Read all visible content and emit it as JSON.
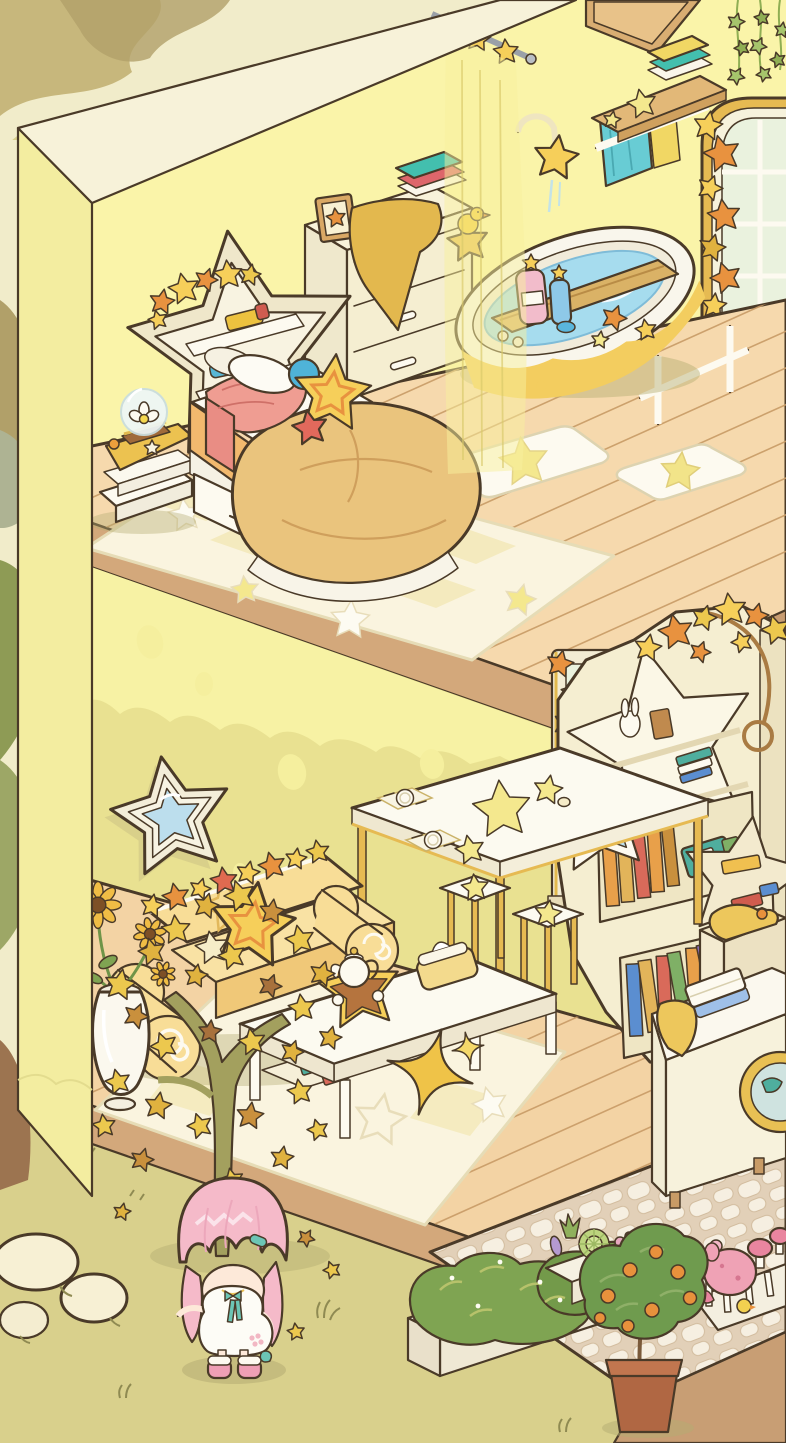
{
  "scene": {
    "description": "two-story isometric dollhouse room: bedroom and bath upstairs, living area downstairs, garden outside with avatar",
    "labels": {
      "canvas": "isometric room scene",
      "backdrop": "outside backdrop foliage",
      "ground": "outdoor ground",
      "leftWall": "outer left wall",
      "upperWall": "upper bedroom wall",
      "lowerWall": "lower living-room wall",
      "upperFloor": "upper wooden plank floor",
      "lowerFloor": "lower wooden plank floor",
      "patio": "cobblestone patio",
      "archWindow": "arched window with star garland",
      "lowerWindow": "lower window with star garland",
      "ivy": "hanging ivy vines",
      "wallBoard": "wooden wall board",
      "showerRod": "curtain rod with star hooks",
      "showerCurtain": "sheer shower curtain",
      "shower": "star shower head",
      "towelShelf": "wall towel shelf with towels",
      "towelRail": "white towel rail",
      "bathtub": "bathtub with blue water and bath tray",
      "bathCaddy": "bath wall caddy",
      "bathMatA": "white star bath mat",
      "bathMatB": "white bath mat with yellow star",
      "dresser": "cream dresser with frame and towels",
      "nightstand": "nightstand with snow globe",
      "headboard": "star-shaped headboard shelf",
      "bed": "bed with golden duvet and star cushions",
      "bedRug": "star patchwork rug",
      "wallMirror": "star wall mirror",
      "sofa": "butter-yellow sofa with star garland",
      "starCushion": "yellow star cushion",
      "coffeeTable": "coffee table with tea tray",
      "teaTray": "star tea tray with teapot",
      "tissueBox": "butter tissue box",
      "sparkleStar": "gold sparkle star ornament",
      "livingRug": "living room rug",
      "diningTable": "dining table with place settings",
      "stools": "star stools",
      "bookshelf": "star bookshelf with books",
      "shelfMirror": "small star mirror",
      "vase": "white vase with sunflowers",
      "washer": "laundry machine with folded towels",
      "hamper": "laundry hamper with clothes",
      "tree": "golden star-leaf tree",
      "rocks": "white garden rocks",
      "bushPlanter": "planter with flowering bushes",
      "succulentPlanter": "succulent planter",
      "mushroomPlanter": "pink mushroom planter",
      "orangeTree": "potted orange tree",
      "avatar": "pink-haired chibi character"
    }
  },
  "palette": {
    "outline": "#4a3a28",
    "ground": "#d9d08c",
    "bdCream": "#f1ecca",
    "bdTan": "#c7b77c",
    "bdTanD": "#b1a069",
    "bdOlive": "#8e9b55",
    "bdGrey": "#aeb393",
    "bdTrunk": "#9c7450",
    "wallTop": "#f7f2d9",
    "wallFace": "#f3eda0",
    "wallU": "#faf4a9",
    "wallL": "#e9e191",
    "wallSpot": "#f5ef9e",
    "wallDrip": "#f7f2a4",
    "slab": "#d3a87b",
    "slabD": "#c89d72",
    "woodU": "#f6d9ad",
    "woodL": "#f3d3a4",
    "woodLine": "#c89b66",
    "rug": "#faf4df",
    "rugTile": "#f3e9bb",
    "rugEdge": "#e6dcb6",
    "white": "#fefcf6",
    "cream": "#f5eed1",
    "creamD": "#efe6c4",
    "creamSh": "#eee6cf",
    "butter": "#f8dd97",
    "butterSh": "#f0c878",
    "starY": "#f6cf5a",
    "starO": "#e8923f",
    "starP": "#f4e88e",
    "gold": "#e6ba52",
    "goldD": "#dab266",
    "teal": "#43bfae",
    "aqua": "#68ccd4",
    "redT": "#dd666b",
    "yellT": "#f1d764",
    "water": "#a6dcee",
    "waterD": "#7fbcd8",
    "drip": "#f3cd5f",
    "glass": "#bcdeed",
    "pane": "#eaf2de",
    "duvet": "#eac47d",
    "duvetLn": "#cf9f5c",
    "mattress": "#f2b96e",
    "blanket": "#ef9d92",
    "blue": "#4fb3d8",
    "red": "#e2695c",
    "ivy": "#a6c56c",
    "ivyD": "#8fae53",
    "leafY": "#ecc84e",
    "leafD": "#e0b23f",
    "leafG": "#c9903d",
    "leafBr": "#a8713c",
    "trunkT": "#a3a05e",
    "bushG": "#7fa452",
    "bushL": "#b7c26b",
    "stone": "#f6efe1",
    "stoneGap": "#e2d0b8",
    "patioSide": "#c89e74",
    "terra": "#b06743",
    "mush": "#efa2b5",
    "mushD": "#e9859f",
    "hair": "#f5bac9",
    "hairD": "#eca7bb",
    "skin": "#fde9d9",
    "boots": "#ef9fb5",
    "ribbon": "#6cc5b5",
    "shadow": "#b4ac72",
    "bookO": "#e8a04a",
    "bookR": "#d96a5a",
    "bookT": "#4fae9e",
    "bookB": "#5b8ed0",
    "bookP": "#8e6fc2",
    "bookG": "#7fb066",
    "pinkBtl": "#f2bccb",
    "blueBtl": "#8ec9e8",
    "butterBox": "#f3da8d"
  }
}
